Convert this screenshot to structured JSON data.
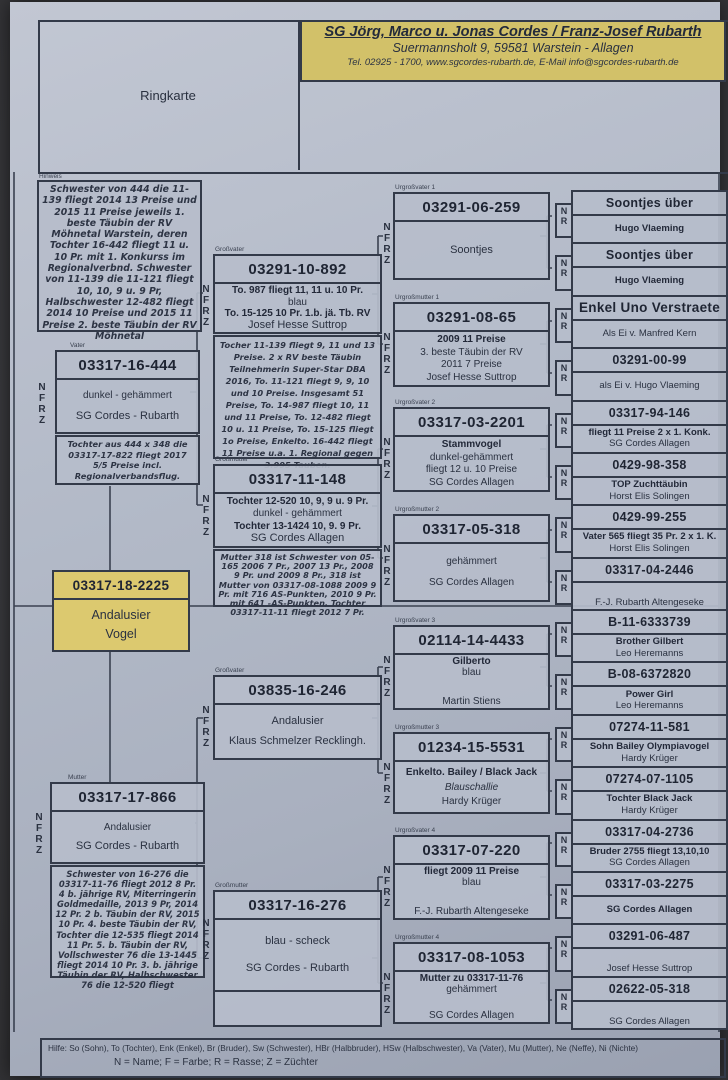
{
  "page": {
    "ringkarte_label": "Ringkarte",
    "header": {
      "owner": "SG Jörg, Marco u. Jonas Cordes / Franz-Josef Rubarth",
      "address": "Suermannsholt 9, 59581 Warstein - Allagen",
      "contact": "Tel. 02925 - 1700, www.sgcordes-rubarth.de, E-Mail info@sgcordes-rubarth.de"
    },
    "colors": {
      "paper": "#b3bac8",
      "highlight_yellow": "#d2c169",
      "ink": "#333a49"
    },
    "letters_nfrz": [
      "N",
      "F",
      "R",
      "Z"
    ],
    "letters_nr": [
      "N",
      "R"
    ],
    "footer": {
      "help": "Hilfe: So (Sohn), To (Tochter), Enk (Enkel), Br (Bruder), Sw (Schwester), HBr (Halbbruder), HSw (Halbschwester), Va (Vater), Mu (Mutter), Ne (Neffe), Ni (Nichte)",
      "legend": "N = Name; F = Farbe; R = Rasse; Z = Züchter"
    }
  },
  "hinweis": {
    "label": "Hinweis",
    "text": "Schwester von 444 die 11-139 fliegt 2014 13 Preise und 2015 11 Preise jeweils 1. beste Täubin der RV Möhnetal Warstein, deren Tochter 16-442 fliegt 11 u. 10 Pr. mit 1. Konkurss im Regionalverbnd. Schwester von 11-139 die 11-121 fliegt 10, 10, 9 u. 9 Pr, Halbschwester 12-482 fliegt 2014 10 Preise und 2015 11 Preise 2. beste Täubin der RV Möhnetal"
  },
  "subject": {
    "ring": "03317-18-2225",
    "line1": "Andalusier",
    "line2": "Vogel"
  },
  "vater": {
    "label": "Vater",
    "ring": "03317-16-444",
    "rows": [
      "dunkel - gehämmert",
      "SG Cordes - Rubarth"
    ],
    "note": "Tochter aus 444 x 348 die 03317-17-822 fliegt 2017 5/5 Preise incl. Regionalverbandsflug."
  },
  "mutter": {
    "label": "Mutter",
    "ring": "03317-17-866",
    "rows": [
      "Andalusier",
      "SG Cordes - Rubarth"
    ],
    "note": "Schwester von 16-276 die 03317-11-76 fliegt 2012 8 Pr. 4 b. jährige RV, Miterringerin Goldmedaille, 2013 9 Pr, 2014 12 Pr. 2 b. Täubin der RV, 2015 10 Pr. 4. beste Täubin der RV, Tochter die 12-535 fliegt 2014 11 Pr. 5. b. Täubin der RV, Vollschwester 76 die 13-1445 fliegt 2014 10 Pr. 3. b. jährige Täubin der RV, Halbschwester 76 die 12-520 fliegt"
  },
  "grandparents": [
    {
      "label": "Großvater",
      "ring": "03291-10-892",
      "rows": [
        "To. 987 fliegt 11, 11 u. 10 Pr.",
        "blau",
        "To. 15-125 10 Pr. 1.b. jä. Tb. RV",
        "Josef Hesse Suttrop"
      ],
      "note": "Tocher 11-139 fliegt 9, 11 und 13 Preise. 2 x RV beste Täubin Teilnehmerin Super-Star DBA 2016, To. 11-121 fliegt 9, 9, 10 und 10 Preise. Insgesamt 51 Preise, To. 14-987 fliegt 10, 11 und 11 Preise, To. 12-482 fliegt 10 u. 11 Preise, To. 15-125 fliegt 1o Preise, Enkelto. 16-442 fliegt 11 Preise u.a. 1. Regional gegen 3.995 Tauben."
    },
    {
      "label": "Großmutter",
      "ring": "03317-11-148",
      "rows": [
        "Tochter 12-520 10, 9, 9 u. 9 Pr.",
        "dunkel - gehämmert",
        "Tochter 13-1424 10, 9. 9 Pr.",
        "SG Cordes Allagen"
      ],
      "note": "Mutter 318 ist Schwester von 05-165 2006 7 Pr., 2007 13 Pr., 2008 9 Pr. und 2009 8 Pr., 318 ist Mutter von 03317-08-1088 2009 9 Pr. mit 716 AS-Punkten, 2010 9 Pr. mit 641 -AS-Punkten, Tochter 03317-11-11 fliegt 2012 7 Pr."
    },
    {
      "label": "Großvater",
      "ring": "03835-16-246",
      "rows": [
        "Andalusier",
        "Klaus Schmelzer Recklingh."
      ],
      "note": ""
    },
    {
      "label": "Großmutter",
      "ring": "03317-16-276",
      "rows": [
        "blau - scheck",
        "SG Cordes - Rubarth"
      ],
      "note": ""
    }
  ],
  "great_grandparents": [
    {
      "label": "Urgroßvater 1",
      "ring": "03291-06-259",
      "rows": [
        "Soontjes"
      ]
    },
    {
      "label": "Urgroßmutter 1",
      "ring": "03291-08-65",
      "rows": [
        "2009 11 Preise",
        "3. beste Täubin der RV",
        "2011 7 Preise",
        "Josef Hesse Suttrop"
      ]
    },
    {
      "label": "Urgroßvater 2",
      "ring": "03317-03-2201",
      "rows": [
        "Stammvogel",
        "dunkel-gehämmert",
        "fliegt 12 u. 10 Preise",
        "SG Cordes Allagen"
      ]
    },
    {
      "label": "Urgroßmutter 2",
      "ring": "03317-05-318",
      "rows": [
        "gehämmert",
        "SG Cordes Allagen"
      ]
    },
    {
      "label": "Urgroßvater 3",
      "ring": "02114-14-4433",
      "rows": [
        "Gilberto",
        "blau",
        "Martin Stiens"
      ]
    },
    {
      "label": "Urgroßmutter 3",
      "ring": "01234-15-5531",
      "rows": [
        "Enkelto. Bailey / Black Jack",
        "Blauschallie",
        "Hardy Krüger"
      ]
    },
    {
      "label": "Urgroßvater 4",
      "ring": "03317-07-220",
      "rows": [
        "fliegt 2009 11 Preise",
        "blau",
        "F.-J. Rubarth Altengeseke"
      ]
    },
    {
      "label": "Urgroßmutter 4",
      "ring": "03317-08-1053",
      "rows": [
        "Mutter zu 03317-11-76",
        "gehämmert",
        "SG Cordes Allagen"
      ]
    }
  ],
  "gg_grandparents": [
    {
      "title": "Soontjes über",
      "rows": [
        "Hugo Vlaeming"
      ]
    },
    {
      "title": "Soontjes über",
      "rows": [
        "Hugo Vlaeming"
      ]
    },
    {
      "title": "Enkel Uno Verstraete",
      "rows": [
        "Als Ei v. Manfred Kern"
      ]
    },
    {
      "title": "03291-00-99",
      "rows": [
        "als Ei v. Hugo Vlaeming"
      ]
    },
    {
      "title": "03317-94-146",
      "rows": [
        "fliegt 11 Preise 2 x 1. Konk.",
        "SG Cordes Allagen"
      ]
    },
    {
      "title": "0429-98-358",
      "rows": [
        "TOP Zuchttäubin",
        "Horst Elis Solingen"
      ]
    },
    {
      "title": "0429-99-255",
      "rows": [
        "Vater 565 fliegt 35 Pr. 2 x 1. K.",
        "Horst Elis Solingen"
      ]
    },
    {
      "title": "03317-04-2446",
      "rows": [
        "F.-J. Rubarth Altengeseke"
      ]
    },
    {
      "title": "B-11-6333739",
      "rows": [
        "Brother Gilbert",
        "Leo Heremanns"
      ]
    },
    {
      "title": "B-08-6372820",
      "rows": [
        "Power Girl",
        "Leo Heremanns"
      ]
    },
    {
      "title": "07274-11-581",
      "rows": [
        "Sohn Bailey Olympiavogel",
        "Hardy Krüger"
      ]
    },
    {
      "title": "07274-07-1105",
      "rows": [
        "Tochter Black Jack",
        "Hardy Krüger"
      ]
    },
    {
      "title": "03317-04-2736",
      "rows": [
        "Bruder 2755 fliegt 13,10,10",
        "SG Cordes Allagen"
      ]
    },
    {
      "title": "03317-03-2275",
      "rows": [
        "SG Cordes Allagen"
      ]
    },
    {
      "title": "03291-06-487",
      "rows": [
        "Josef Hesse Suttrop"
      ]
    },
    {
      "title": "02622-05-318",
      "rows": [
        "SG Cordes Allagen"
      ]
    }
  ]
}
